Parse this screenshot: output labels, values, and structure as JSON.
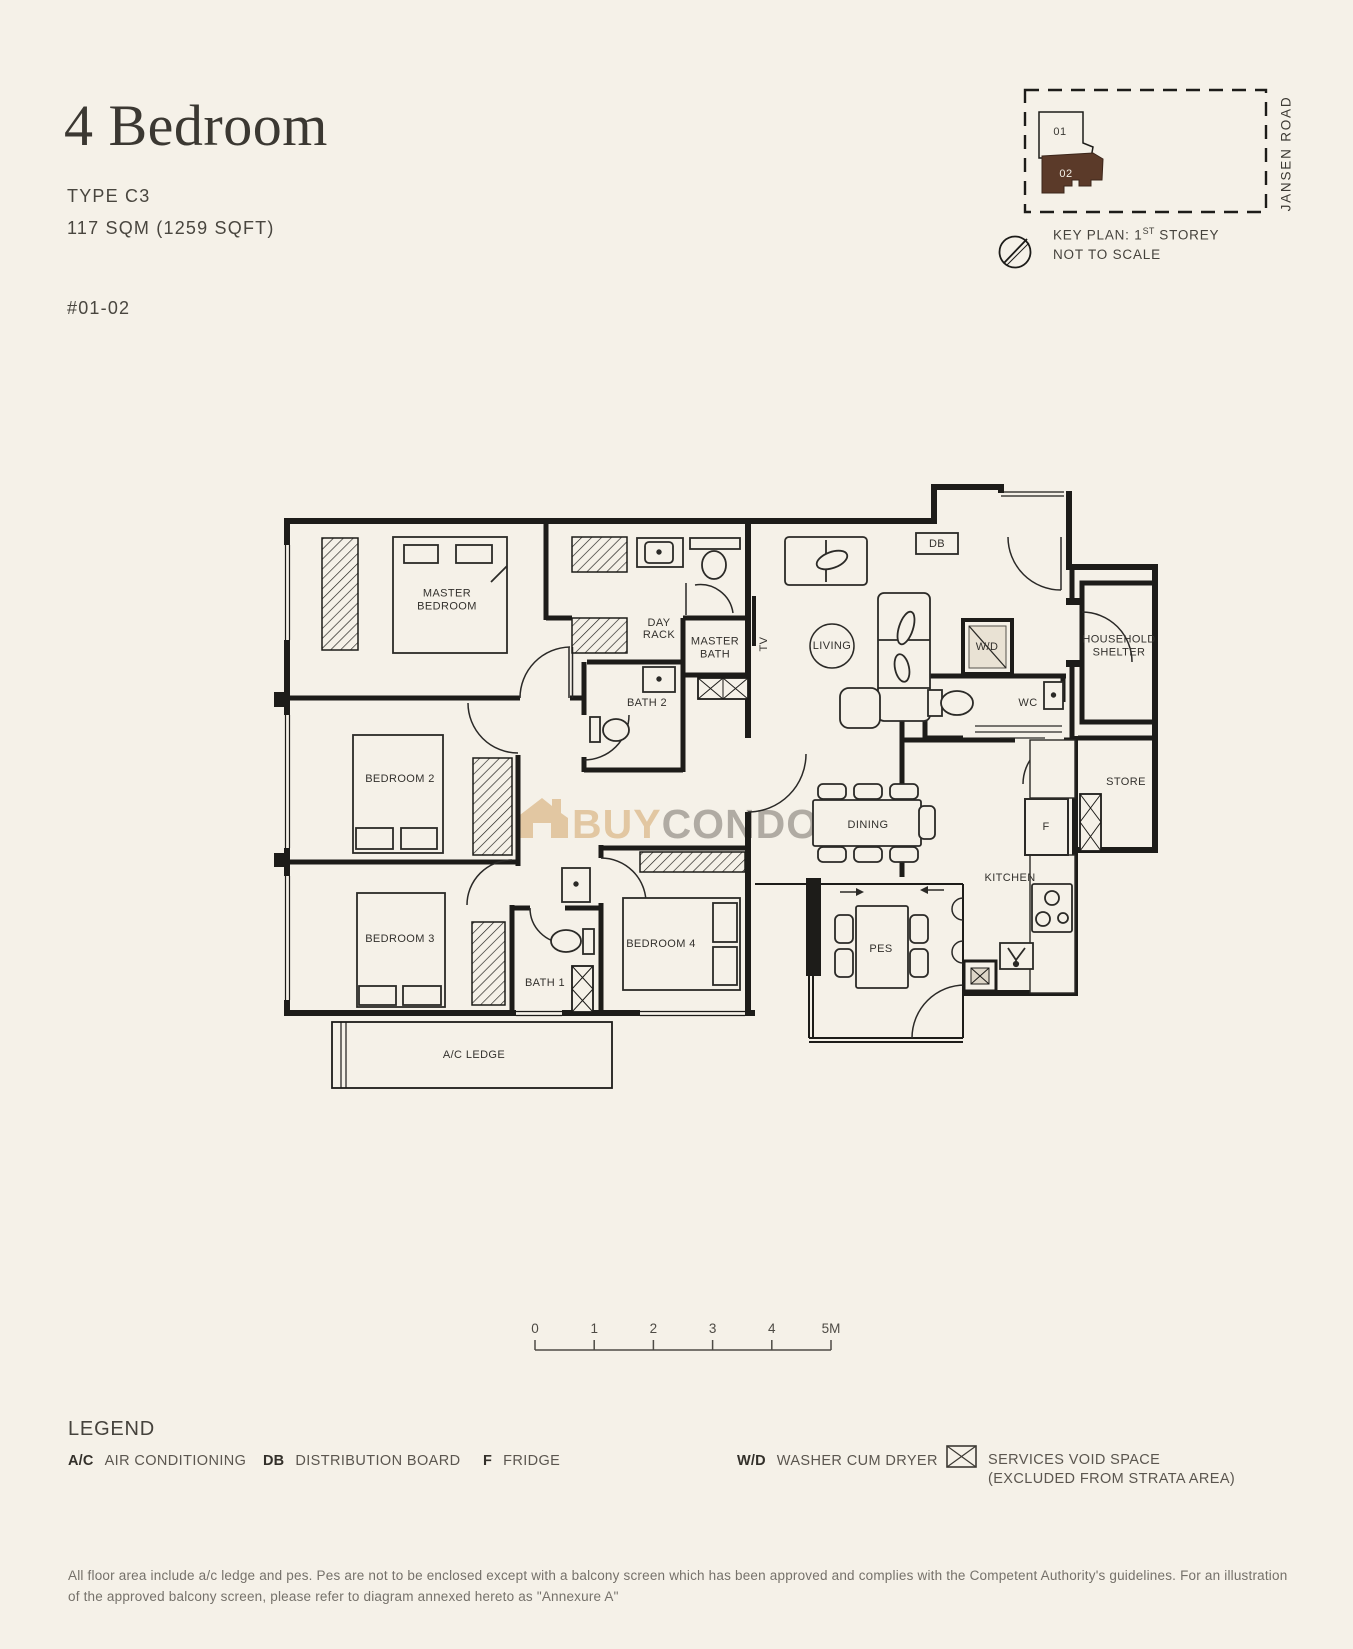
{
  "header": {
    "title": "4 Bedroom",
    "type_label": "TYPE C3",
    "area_label": "117 SQM (1259 SQFT)",
    "unit_label": "#01-02"
  },
  "key_plan": {
    "road_label": "JANSEN ROAD",
    "units": [
      {
        "label": "01"
      },
      {
        "label": "02"
      }
    ],
    "highlight_color": "#5b3a29",
    "caption_prefix": "KEY PLAN: 1",
    "caption_sup": "ST",
    "caption_suffix": " STOREY",
    "caption_line2": "NOT TO SCALE"
  },
  "floor_plan": {
    "labels": [
      {
        "id": "master-bedroom",
        "lines": [
          "MASTER",
          "BEDROOM"
        ],
        "x": 447,
        "y": 600,
        "lh": 13
      },
      {
        "id": "day-rack",
        "lines": [
          "DAY",
          "RACK"
        ],
        "x": 659,
        "y": 629,
        "lh": 12,
        "size": 10
      },
      {
        "id": "master-bath",
        "lines": [
          "MASTER",
          "BATH"
        ],
        "x": 715,
        "y": 648,
        "lh": 13
      },
      {
        "id": "bath-2",
        "lines": [
          "BATH 2"
        ],
        "x": 647,
        "y": 703
      },
      {
        "id": "living",
        "lines": [
          "LIVING"
        ],
        "x": 832,
        "y": 646
      },
      {
        "id": "tv",
        "lines": [
          "TV"
        ],
        "x": 764,
        "y": 644,
        "rotate": -90,
        "size": 10
      },
      {
        "id": "db",
        "lines": [
          "DB"
        ],
        "x": 937,
        "y": 544
      },
      {
        "id": "wd",
        "lines": [
          "W/D"
        ],
        "x": 987,
        "y": 647,
        "size": 10
      },
      {
        "id": "wc",
        "lines": [
          "WC"
        ],
        "x": 1028,
        "y": 703
      },
      {
        "id": "household-shelter",
        "lines": [
          "HOUSEHOLD",
          "SHELTER"
        ],
        "x": 1119,
        "y": 646,
        "lh": 13
      },
      {
        "id": "store",
        "lines": [
          "STORE"
        ],
        "x": 1126,
        "y": 782
      },
      {
        "id": "bedroom-2",
        "lines": [
          "BEDROOM 2"
        ],
        "x": 400,
        "y": 779
      },
      {
        "id": "bedroom-3",
        "lines": [
          "BEDROOM 3"
        ],
        "x": 400,
        "y": 939
      },
      {
        "id": "bedroom-4",
        "lines": [
          "BEDROOM 4"
        ],
        "x": 661,
        "y": 944
      },
      {
        "id": "bath-1",
        "lines": [
          "BATH 1"
        ],
        "x": 545,
        "y": 983,
        "size": 10
      },
      {
        "id": "dining",
        "lines": [
          "DINING"
        ],
        "x": 868,
        "y": 825
      },
      {
        "id": "kitchen",
        "lines": [
          "KITCHEN"
        ],
        "x": 1010,
        "y": 878
      },
      {
        "id": "pes",
        "lines": [
          "PES"
        ],
        "x": 881,
        "y": 949
      },
      {
        "id": "fridge",
        "lines": [
          "F"
        ],
        "x": 1046,
        "y": 827,
        "size": 10
      },
      {
        "id": "ac-ledge",
        "lines": [
          "A/C LEDGE"
        ],
        "x": 474,
        "y": 1055
      }
    ]
  },
  "watermark": {
    "prefix": "BUY",
    "suffix": "CONDO.sg",
    "prefix_color": "#ddbc8f",
    "suffix_color": "#9d9890"
  },
  "scale_bar": {
    "ticks": [
      "0",
      "1",
      "2",
      "3",
      "4",
      "5M"
    ]
  },
  "legend": {
    "title": "LEGEND",
    "items": [
      {
        "abbr": "A/C",
        "label": "AIR CONDITIONING"
      },
      {
        "abbr": "DB",
        "label": "DISTRIBUTION BOARD"
      },
      {
        "abbr": "F",
        "label": "FRIDGE"
      },
      {
        "abbr": "W/D",
        "label": "WASHER CUM DRYER"
      }
    ],
    "void_item": {
      "line1": "SERVICES VOID SPACE",
      "line2": "(EXCLUDED FROM STRATA AREA)"
    }
  },
  "disclaimer": "All floor area include a/c ledge and pes. Pes are not to be enclosed except with a balcony screen which has been approved and complies with the Competent Authority's guidelines. For an illustration of the approved balcony screen, please refer to diagram annexed hereto as \"Annexure A\""
}
